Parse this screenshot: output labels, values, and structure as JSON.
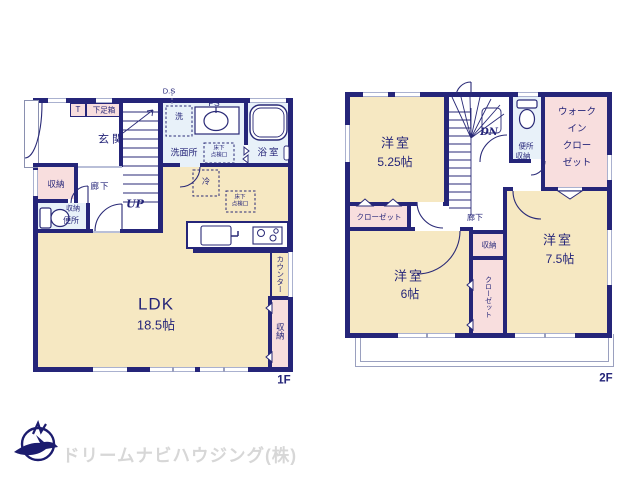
{
  "floor1": {
    "tag": "1F",
    "ds": "D.S",
    "t": "T",
    "shoe_box": "下足箱",
    "entrance": "玄関",
    "washer": "洗",
    "ps": "PS",
    "washroom": "洗面所",
    "underfloor1": "床下",
    "underfloor2": "点検口",
    "bathroom": "浴室",
    "storage": "収納",
    "hallway": "廊下",
    "toilet": "便所",
    "up": "UP",
    "fridge": "冷",
    "ldk": "LDK",
    "ldk_size": "18.5帖",
    "counter": "カウンター"
  },
  "floor2": {
    "tag": "2F",
    "dn": "DN",
    "room": "洋室",
    "size525": "5.25帖",
    "size6": "6帖",
    "size75": "7.5帖",
    "closet": "クローゼット",
    "wic1": "ウォーク",
    "wic2": "イン",
    "wic3": "クロー",
    "wic4": "ゼット",
    "toilet": "便所",
    "storage": "収納",
    "hallway": "廊下"
  },
  "logo": {
    "company": "ドリームナビハウジング(株)"
  },
  "colors": {
    "wall": "#252579",
    "room_cream": "#f6e8c2",
    "closet_pink": "#f8dede",
    "wet_blue": "#e8f1f9",
    "window": "#aab1cf",
    "logo_navy": "#1c1c6e",
    "logo_text": "#d7d7d7"
  }
}
